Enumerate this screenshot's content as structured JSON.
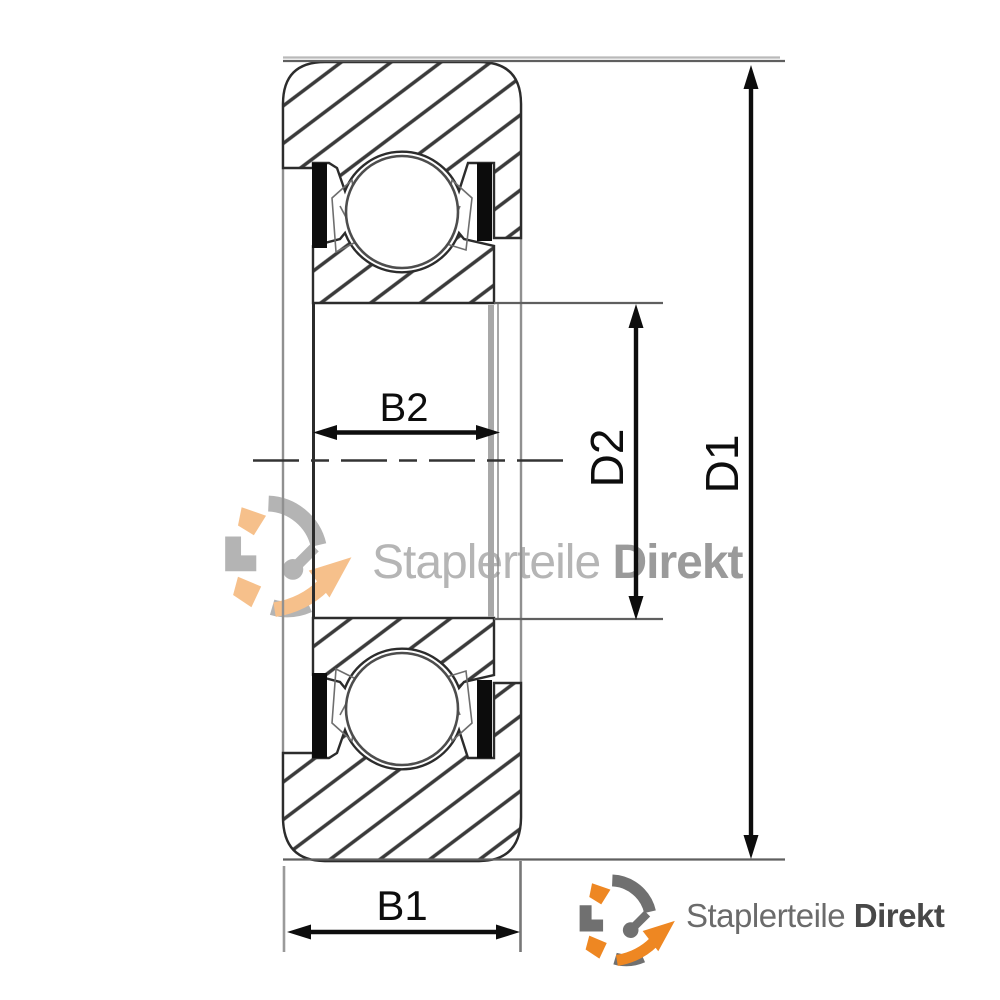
{
  "canvas": {
    "width": 1000,
    "height": 1000,
    "background": "#ffffff"
  },
  "diagram": {
    "name": "bearing-cross-section-drawing",
    "dimensions": {
      "b2": {
        "label": "B2"
      },
      "b1": {
        "label": "B1"
      },
      "d2": {
        "label": "D2"
      },
      "d1": {
        "label": "D1"
      }
    },
    "colors": {
      "dimension": "#0d0d0d",
      "hatch": "#3a3a3a",
      "outline": "#2c2c2c",
      "sketch_gray": "#9a9a9a",
      "seal": "#0c0c0c"
    }
  },
  "watermark": {
    "brand_regular": "Staplerteile",
    "brand_bold": "Direkt",
    "regular_color": "#b5b5b5",
    "bold_color": "#9a9a9a"
  },
  "logo": {
    "brand_regular": "Staplerteile",
    "brand_bold": "Direkt",
    "regular_color": "#6b6b6b",
    "bold_color": "#484848",
    "orange": "#EE8722",
    "gray": "#707070"
  }
}
